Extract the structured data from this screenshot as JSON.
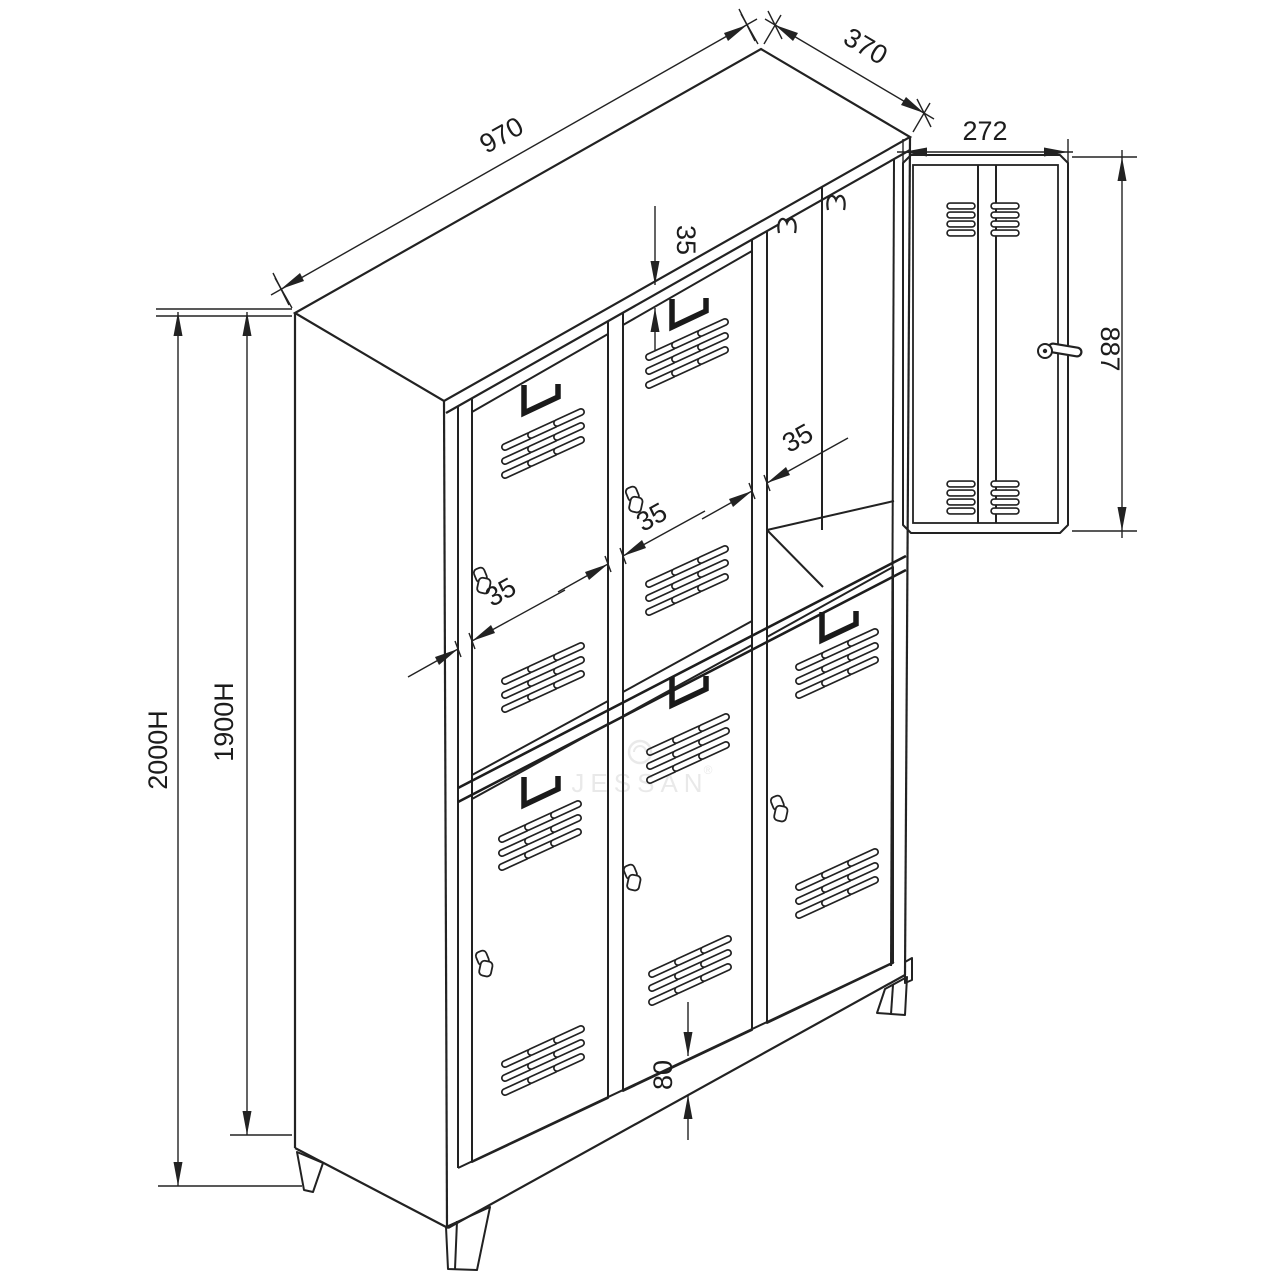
{
  "diagram": {
    "type": "technical-drawing",
    "subject": "six-door metal locker cabinet, isometric view with open door detail",
    "watermark": {
      "brand": "JESSAN",
      "registered": "®"
    },
    "dimensions": {
      "top_width": "970",
      "top_depth": "370",
      "door_width": "272",
      "door_height": "887",
      "overall_height": "2000H",
      "body_height": "1900H",
      "gap_top": "35",
      "gap_left": "35",
      "gap_mullion1": "35",
      "gap_mullion2": "35",
      "plinth_height": "80"
    }
  }
}
